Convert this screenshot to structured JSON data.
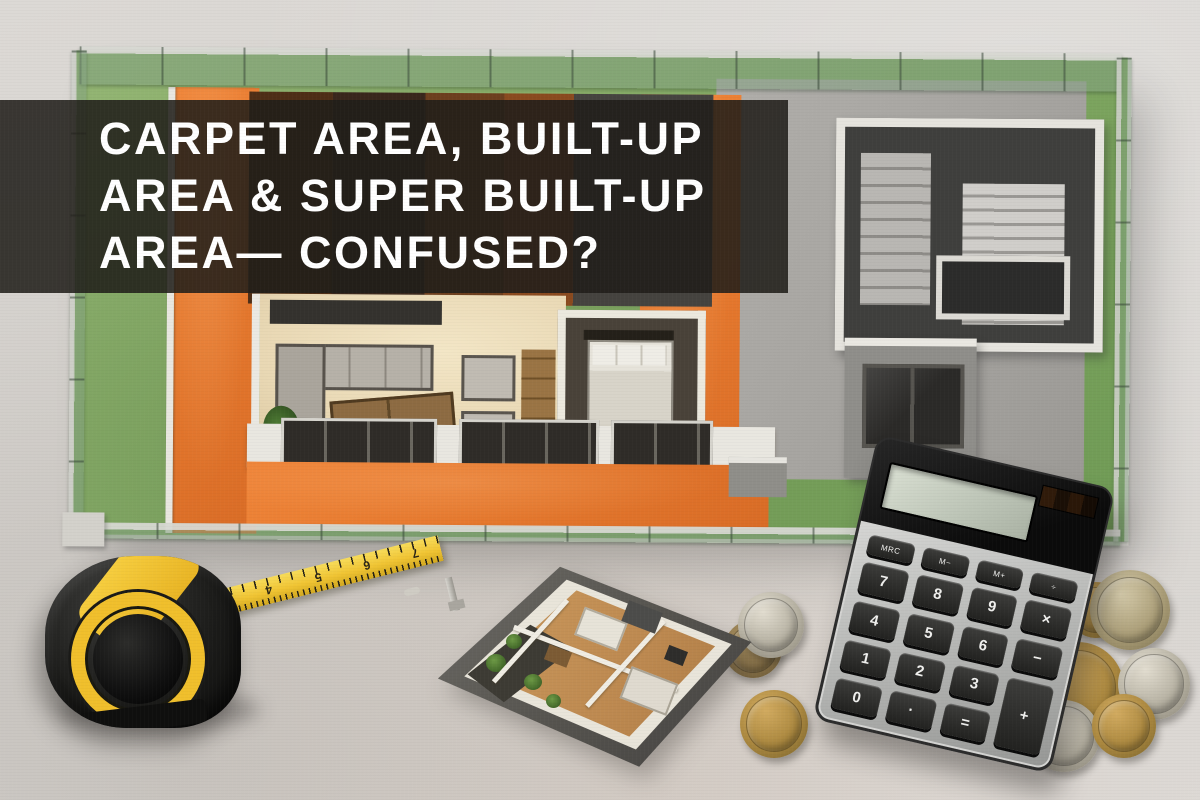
{
  "banner": {
    "lines": [
      "CARPET AREA, BUILT-UP",
      "AREA & SUPER BUILT-UP",
      "AREA— CONFUSED?"
    ],
    "text_color": "#ffffff",
    "background": "rgba(32,30,25,0.87)"
  },
  "scene": {
    "description_objects": [
      "floor-plan-model",
      "tape-measure",
      "mini-house-model",
      "calculator",
      "coins"
    ],
    "colors": {
      "background_concrete": "#d8d5d1",
      "lawn_green": "#86ab67",
      "terrace_orange": "#e4772d",
      "interior_cream": "#ecdcba",
      "courtyard_gray": "#a7a5a1",
      "wall_white": "#e9e7e0",
      "tape_yellow": "#f0c433",
      "calculator_key_dark": "#2d2d2b"
    }
  },
  "tape_measure": {
    "numbers": [
      "3",
      "4",
      "5",
      "6",
      "7"
    ]
  },
  "calculator": {
    "display_value": "",
    "function_keys": [
      "MRC",
      "M−",
      "M+",
      "÷"
    ],
    "keys": [
      "7",
      "8",
      "9",
      "×",
      "4",
      "5",
      "6",
      "−",
      "1",
      "2",
      "3",
      "+",
      "0",
      "·",
      "="
    ]
  },
  "coins": {
    "left_cluster_count": 3,
    "right_cluster_count": 6
  }
}
